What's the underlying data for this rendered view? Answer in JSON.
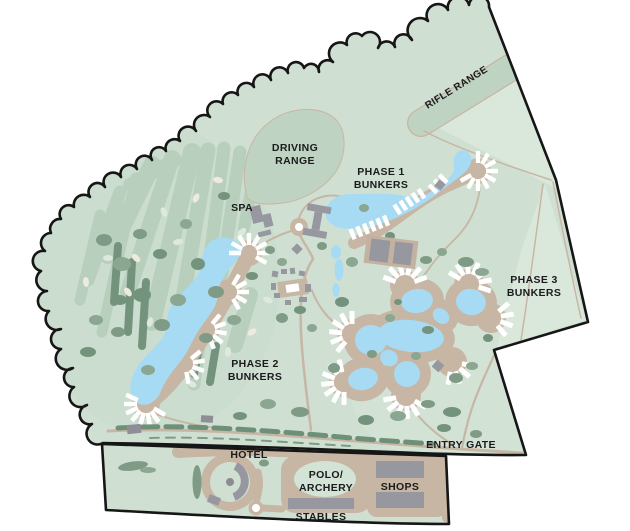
{
  "map": {
    "labels": {
      "rifle_range": "RIFLE RANGE",
      "driving_range": {
        "l1": "DRIVING",
        "l2": "RANGE"
      },
      "spa": "SPA",
      "phase1": {
        "l1": "PHASE 1",
        "l2": "BUNKERS"
      },
      "phase2": {
        "l1": "PHASE 2",
        "l2": "BUNKERS"
      },
      "phase3": {
        "l1": "PHASE 3",
        "l2": "BUNKERS"
      },
      "entry_gate": "ENTRY GATE",
      "hotel": "HOTEL",
      "polo": {
        "l1": "POLO/",
        "l2": "ARCHERY"
      },
      "shops": "SHOPS",
      "stables": "STABLES"
    },
    "colors": {
      "land": "#cfe0d3",
      "land_light": "#dae8db",
      "fairway": "#b9cfbd",
      "range_green": "#bed3c1",
      "tree": "#7f9b85",
      "water": "#a7dbf4",
      "road_tan": "#c8b6a4",
      "lot_white": "#ffffff",
      "building_gray": "#97979f",
      "boundary": "#161616",
      "label_text": "#1b1b1d"
    }
  }
}
